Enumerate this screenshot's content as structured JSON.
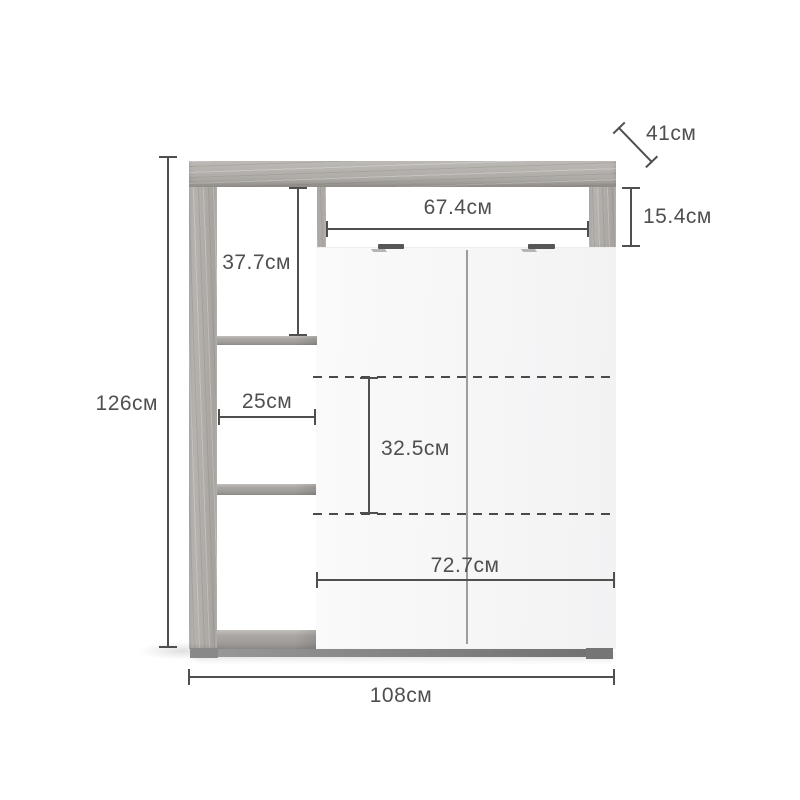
{
  "diagram": {
    "subject": "cabinet-dimension-diagram",
    "unit": "см",
    "labels": {
      "total_height": "126см",
      "upper_left_height": "37.7см",
      "shelf_width": "25см",
      "niche_width": "67.4см",
      "top_right_height": "15.4см",
      "depth": "41см",
      "mid_section_height": "32.5см",
      "doors_width": "72.7см",
      "total_width": "108см"
    },
    "colors": {
      "background": "#ffffff",
      "dimension_line": "#4f4f4f",
      "label_text": "#4f4f4f",
      "wood": "#b4b1ad",
      "door_face": "#f6f6f6",
      "door_divider": "#9d9d9d",
      "handle": "#565656",
      "plinth": "#757575"
    }
  }
}
